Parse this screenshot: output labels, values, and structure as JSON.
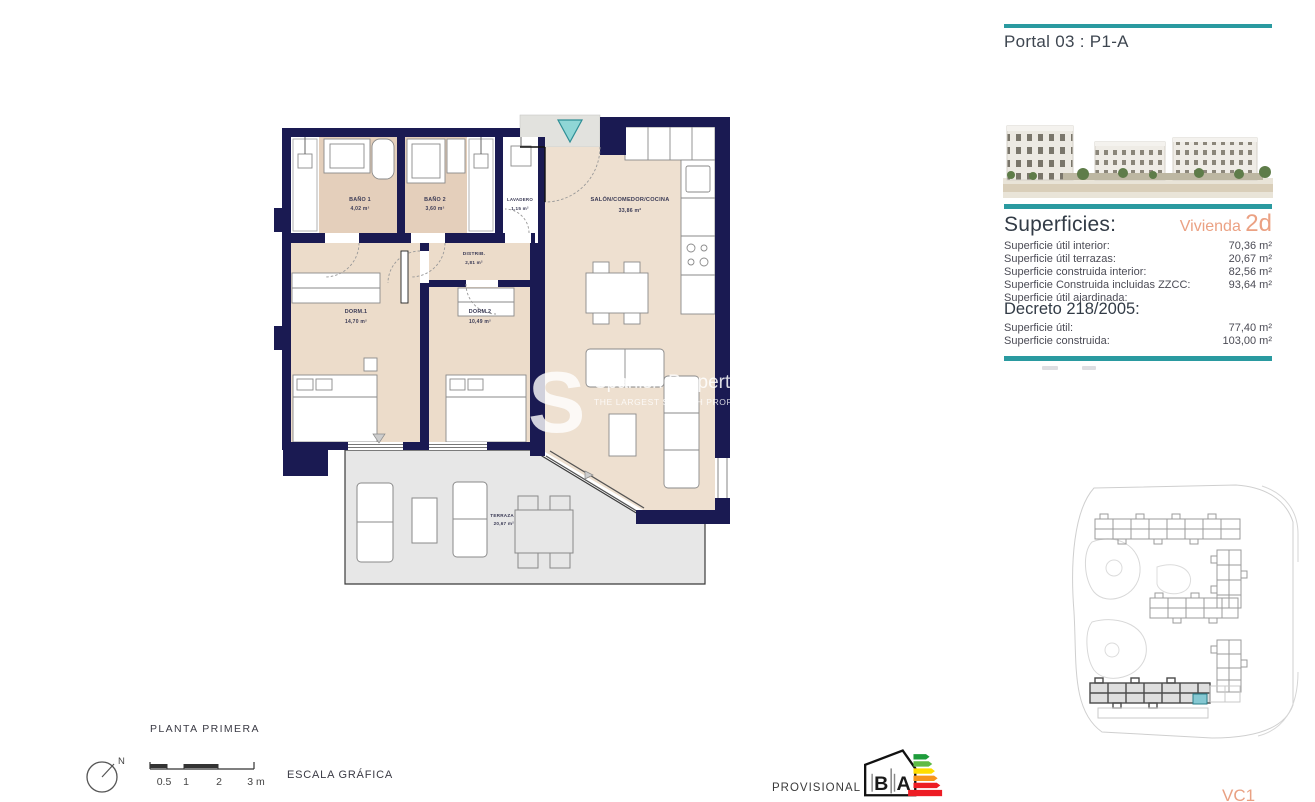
{
  "header": {
    "portal_title": "Portal 03 : P1-A"
  },
  "colors": {
    "teal": "#2A9AA0",
    "navy": "#1A1A52",
    "orange": "#EBA183",
    "beige_floor": "#ECDCCA",
    "bath_floor": "#E4CFBB",
    "terrace_grey": "#E7E7E7"
  },
  "floorplan": {
    "rooms": {
      "bano1": {
        "name": "BAÑO 1",
        "area": "4,02 m²"
      },
      "bano2": {
        "name": "BAÑO 2",
        "area": "3,60 m²"
      },
      "lavadero": {
        "name": "LAVADERO",
        "area": "1,15 m²"
      },
      "distrib": {
        "name": "DISTRIB.",
        "area": "2,81 m²"
      },
      "salon": {
        "name": "SALÓN/COMEDOR/COCINA",
        "area": "33,86 m²"
      },
      "dorm1": {
        "name": "DORM.1",
        "area": "14,70 m²"
      },
      "dorm2": {
        "name": "DORM.2",
        "area": "10,49 m²"
      },
      "terraza": {
        "name": "TERRAZA",
        "area": "20,67 m²"
      }
    }
  },
  "sidebar": {
    "superficies": {
      "heading": "Superficies:",
      "vivienda_label": "Vivienda",
      "vivienda_type": "2d",
      "rows": [
        {
          "label": "Superficie útil interior:",
          "value": "70,36 m²"
        },
        {
          "label": "Superficie útil terrazas:",
          "value": "20,67 m²"
        },
        {
          "label": "Superficie construida interior:",
          "value": "82,56 m²"
        },
        {
          "label": "Superficie Construida incluidas ZZCC:",
          "value": "93,64 m²"
        },
        {
          "label": "Superficie útil ajardinada:",
          "value": ""
        }
      ]
    },
    "decreto": {
      "heading": "Decreto 218/2005:",
      "rows": [
        {
          "label": "Superficie útil:",
          "value": "77,40 m²"
        },
        {
          "label": "Superficie construida:",
          "value": "103,00 m²"
        }
      ]
    }
  },
  "footer": {
    "floor_label": "PLANTA PRIMERA",
    "north_label": "N",
    "scale_ticks": [
      "0.5",
      "1",
      "2",
      "3 m"
    ],
    "scale_label": "ESCALA GRÁFICA",
    "provisional": "PROVISIONAL",
    "energy": {
      "b": "B",
      "a": "A"
    },
    "sheet_code": "VC1"
  },
  "watermark": {
    "letter": "S",
    "line1": "Spanish Property Listings",
    "line2": "THE LARGEST SPANISH PROPERTY LISTING"
  }
}
